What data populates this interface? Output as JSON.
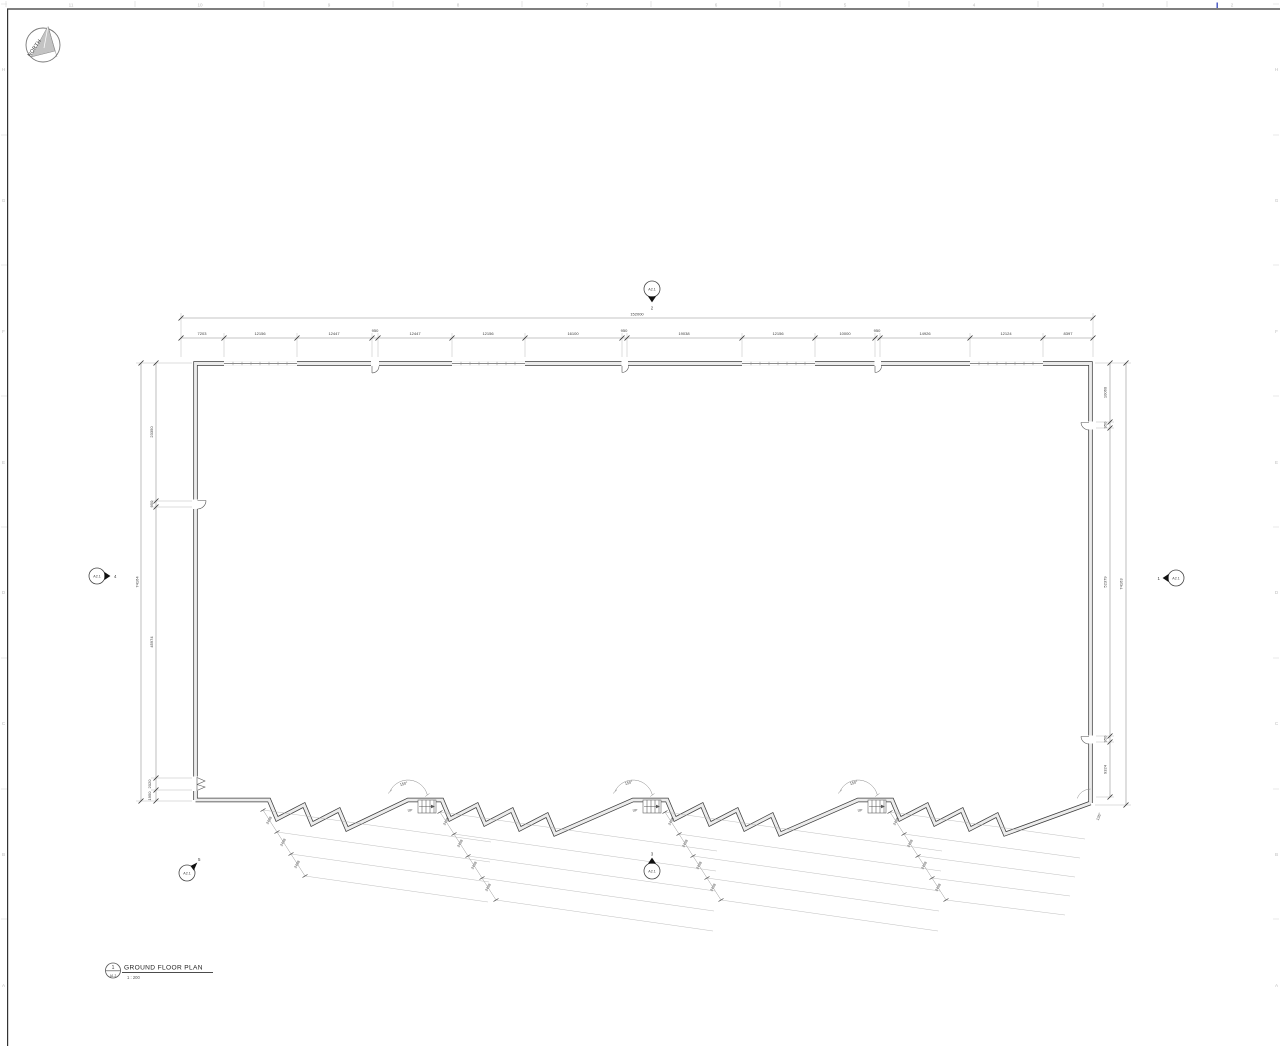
{
  "sheet_grid": {
    "top_numbers": [
      "11",
      "10",
      "9",
      "8",
      "7",
      "6",
      "5",
      "4",
      "3",
      "2"
    ],
    "left_letters": [
      "H",
      "G",
      "F",
      "E",
      "D",
      "C",
      "B",
      "A"
    ],
    "right_letters": [
      "H",
      "G",
      "F",
      "E",
      "D",
      "C",
      "B",
      "A"
    ]
  },
  "north_arrow": {
    "label": "NORTH"
  },
  "view_title": {
    "detail_number": "1",
    "sheet_number": "A1.2",
    "title": "GROUND FLOOR PLAN",
    "scale": "1 : 200"
  },
  "section_markers": {
    "top": {
      "sheet": "A2.1",
      "detail": "2"
    },
    "left": {
      "sheet": "A2.1",
      "detail": "4"
    },
    "right": {
      "sheet": "A2.1",
      "detail": "1"
    },
    "bottom_left": {
      "sheet": "A2.1",
      "detail": "5"
    },
    "bottom_center": {
      "sheet": "A2.1",
      "detail": "3"
    }
  },
  "dimensions": {
    "top_overall": "152000",
    "top_chain": [
      "7203",
      "12156",
      "12447",
      "950",
      "12447",
      "12156",
      "16100",
      "950",
      "19038",
      "12156",
      "10000",
      "950",
      "14926",
      "12124",
      "8397"
    ],
    "left_overall": "74164",
    "left_chain": [
      "23350",
      "950",
      "45974",
      "2020",
      "1950"
    ],
    "right_overall": "74163",
    "right_chain": [
      "10060",
      "950",
      "52379",
      "950",
      "9324"
    ],
    "sawtooth_step": "2438",
    "notch_angle": "150°",
    "corner_angle": "135°"
  },
  "stairs": {
    "up_label": "UP"
  }
}
